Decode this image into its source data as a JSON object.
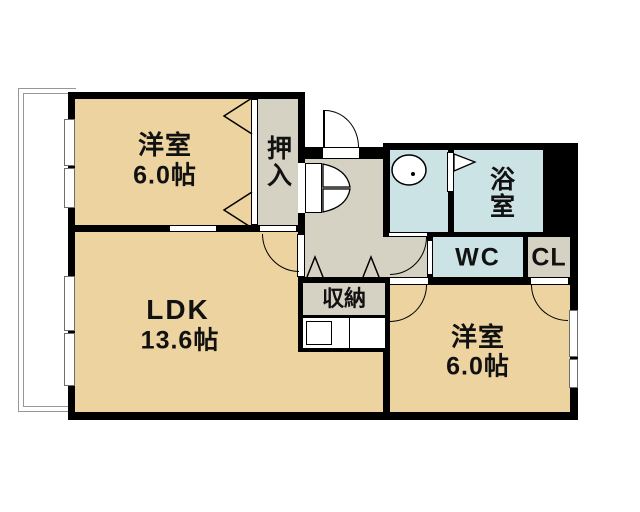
{
  "plan_title": "apartment-floor-plan",
  "colors": {
    "room_tan": "#ecd3a0",
    "hall_greige": "#d5d1c3",
    "wet_area_blue": "#cce3e6",
    "wall_black": "#000000",
    "balcony_outline": "#979797"
  },
  "rooms": {
    "bedroom1": {
      "label": "洋室",
      "size": "6.0帖"
    },
    "oshiire": {
      "label": "押入"
    },
    "bath": {
      "label": "浴室"
    },
    "wc": {
      "label": "WC"
    },
    "closet": {
      "label": "CL"
    },
    "ldk": {
      "label": "LDK",
      "size": "13.6帖"
    },
    "storage": {
      "label": "収納"
    },
    "bedroom2": {
      "label": "洋室",
      "size": "6.0帖"
    }
  }
}
